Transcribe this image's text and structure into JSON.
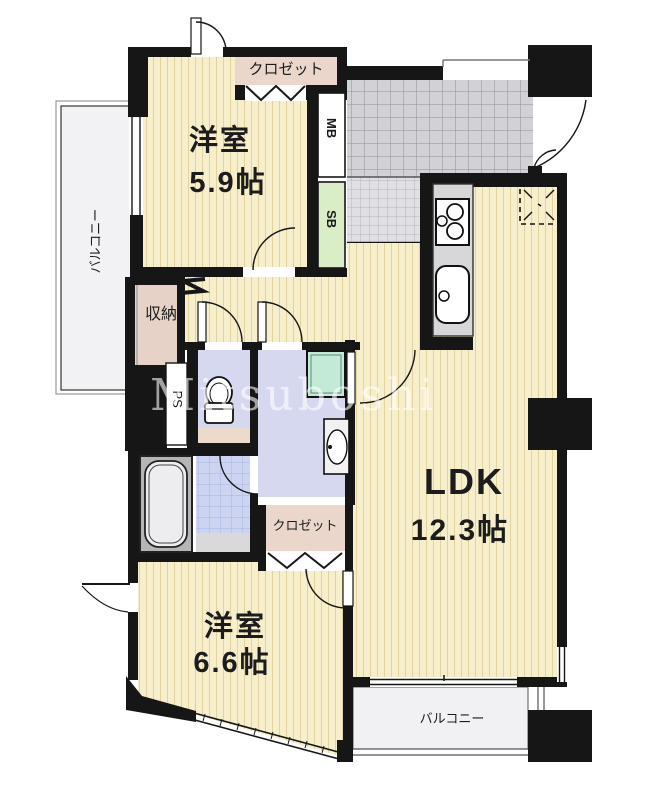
{
  "plan": {
    "watermark": "Mitsuboshi",
    "labels": {
      "bedroom1_name": "洋室",
      "bedroom1_size": "5.9帖",
      "bedroom2_name": "洋室",
      "bedroom2_size": "6.6帖",
      "ldk_name": "LDK",
      "ldk_size": "12.3帖",
      "closet_top": "クロゼット",
      "closet_mid": "クロゼット",
      "storage": "収納",
      "balcony_left": "バルコニー",
      "balcony_bottom": "バルコニー",
      "meter_box": "MB",
      "shoe_box": "SB",
      "pipe_space": "PS"
    },
    "colors": {
      "wall": "#161616",
      "room_floor": "#f7eecb",
      "closet_fill": "#ead6ca",
      "entrance_tile": "#d2d2d6",
      "sanitary_fill": "#d6d8f0",
      "bath_tile": "#cdd4f1",
      "washer_pan": "#c2ead6",
      "shoe_box_fill": "#d9edc6",
      "balcony_fill": "#f1f1f3"
    }
  }
}
